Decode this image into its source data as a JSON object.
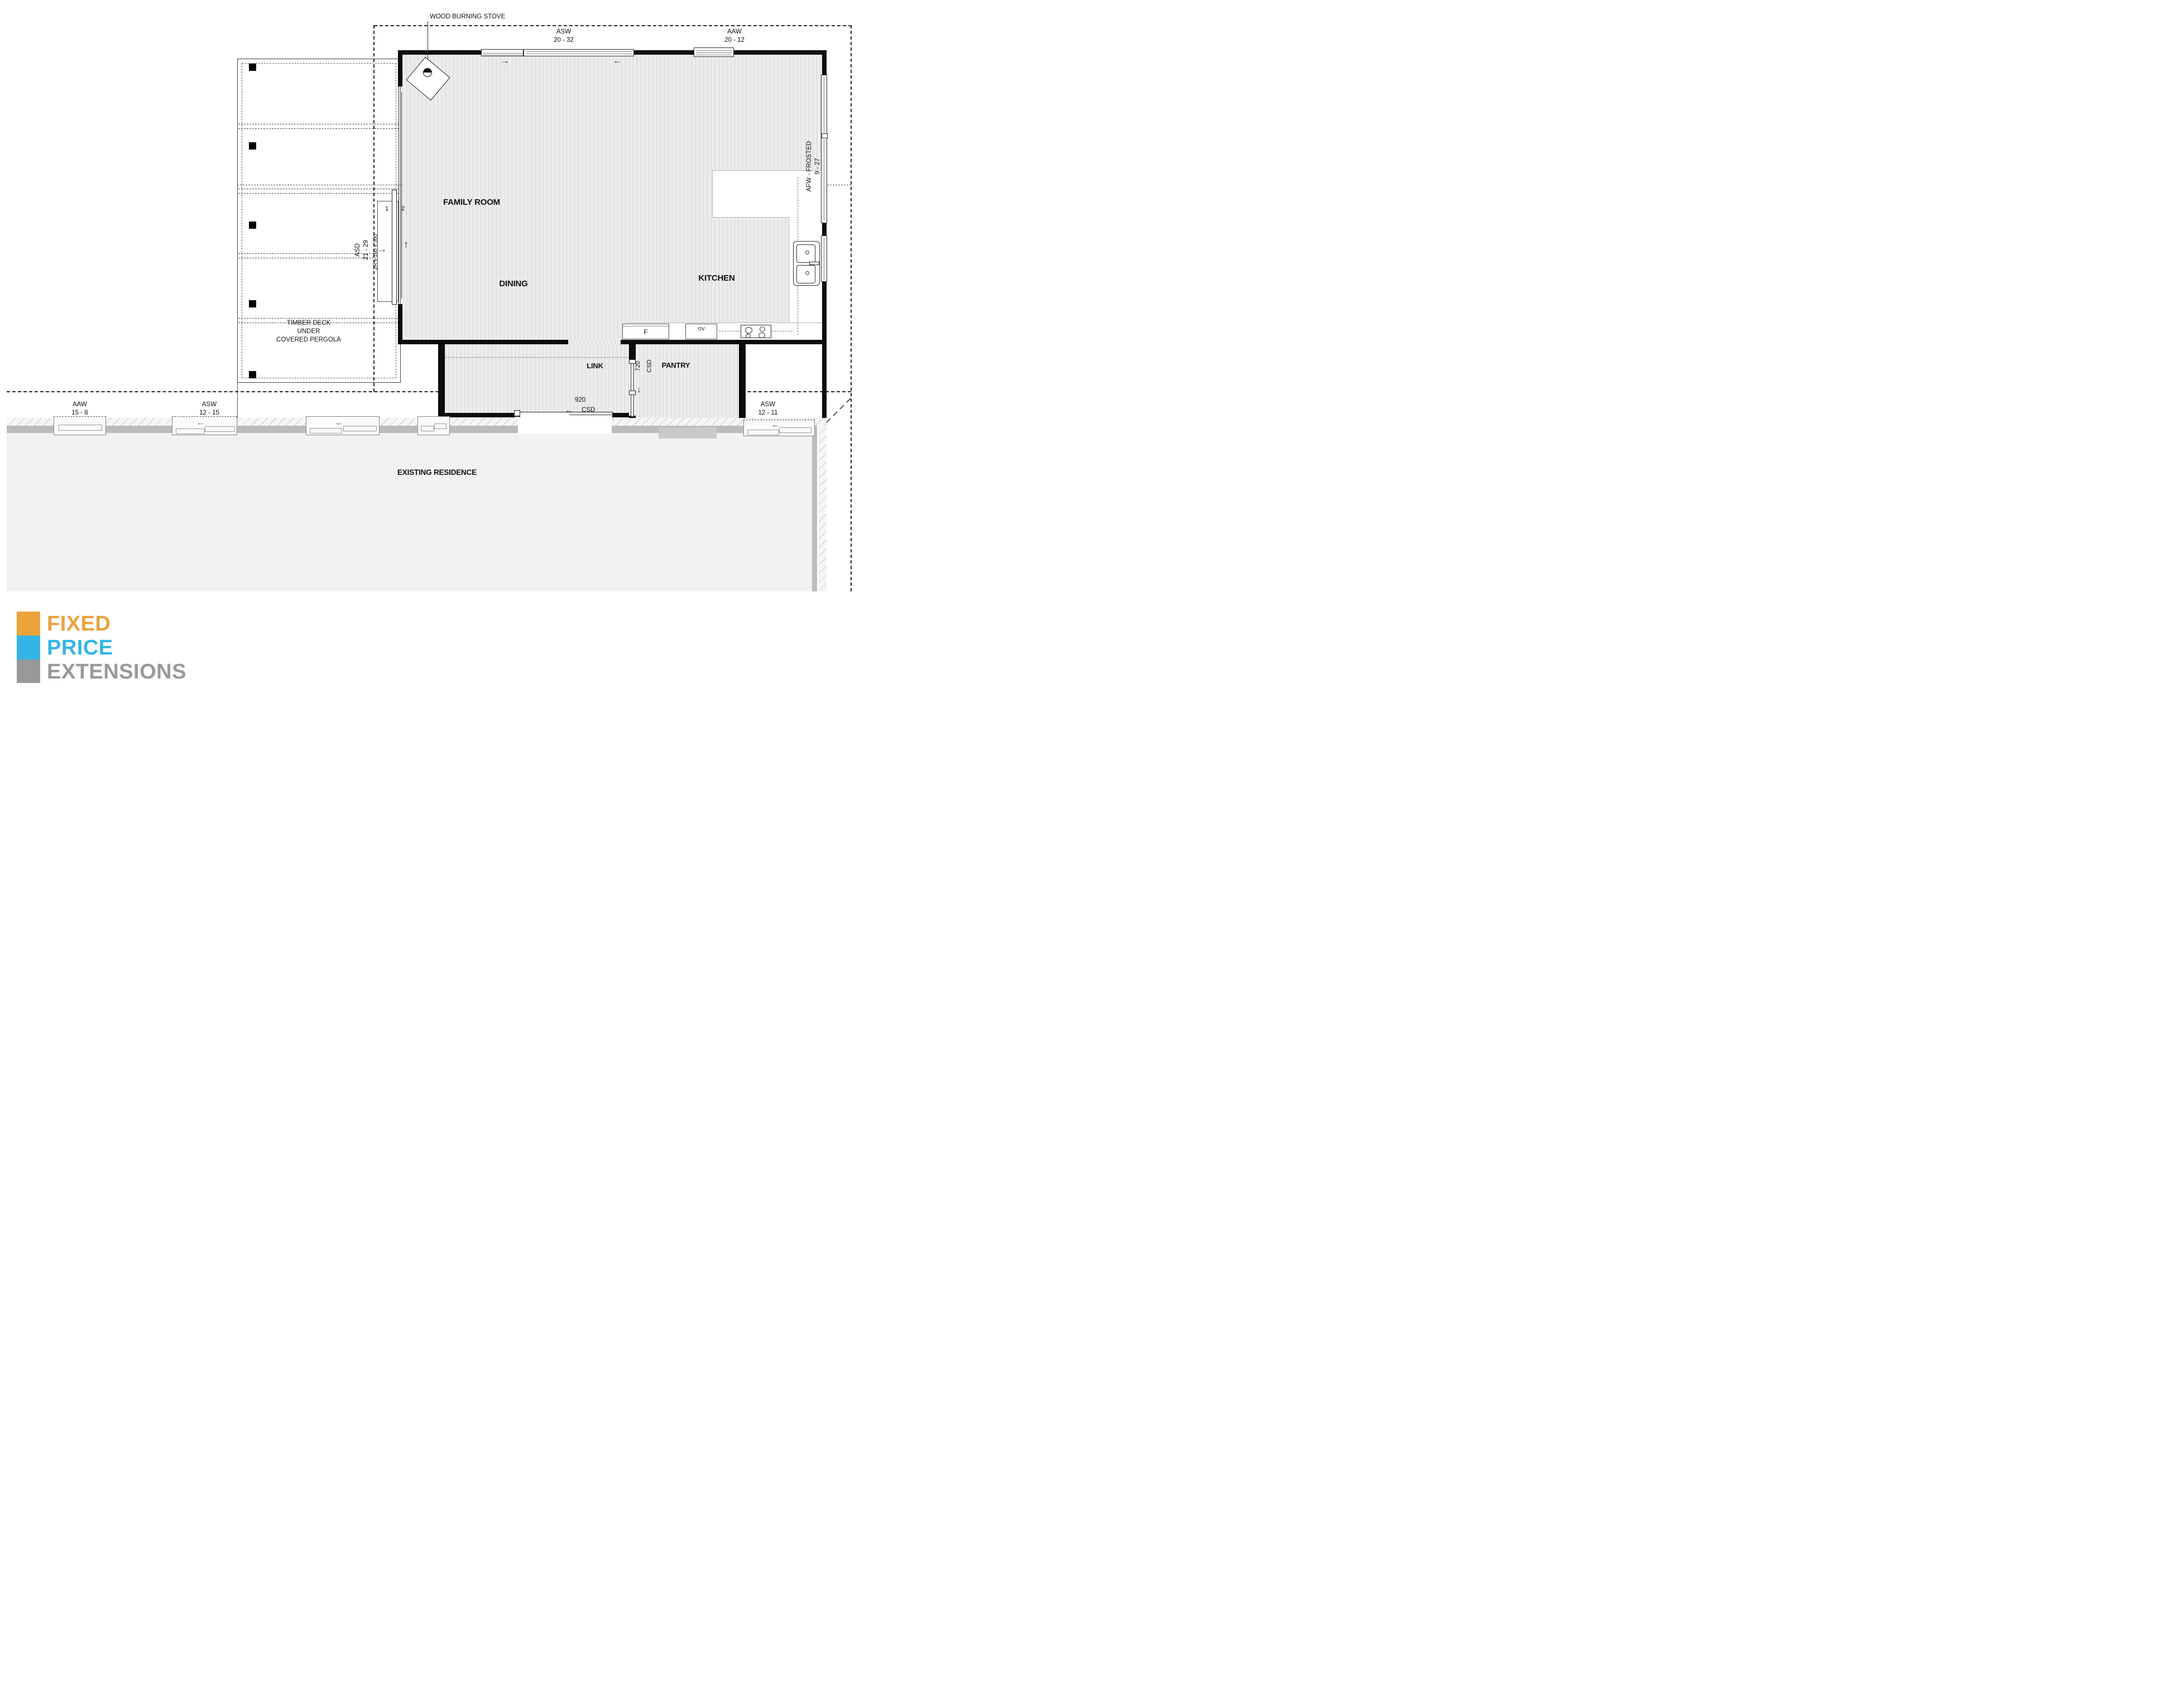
{
  "annotations": {
    "stove_note": "WOOD BURNING STOVE",
    "deck_line1": "TIMBER DECK",
    "deck_line2": "UNDER",
    "deck_line3": "COVERED PERGOLA",
    "steps_note": "2R x 150 x 300",
    "step_1": "1",
    "step_2": "2"
  },
  "rooms": {
    "family": "FAMILY ROOM",
    "dining": "DINING",
    "kitchen": "KITCHEN",
    "link": "LINK",
    "pantry": "PANTRY",
    "existing": "EXISTING RESIDENCE"
  },
  "windows": {
    "asw_top": {
      "code": "ASW",
      "size": "20 - 32"
    },
    "aaw_top": {
      "code": "AAW",
      "size": "20 - 12"
    },
    "afw_right": {
      "code": "AFW - FROSTED",
      "size": "9 - 27"
    },
    "aaw_left": {
      "code": "AAW",
      "size": "15 - 8"
    },
    "asw_mid": {
      "code": "ASW",
      "size": "12 - 15"
    },
    "asw_right": {
      "code": "ASW",
      "size": "12 - 11"
    }
  },
  "doors": {
    "asd": {
      "code": "ASD",
      "size": "21 - 29"
    },
    "csd_link": {
      "size": "920",
      "code": "CSD"
    },
    "csd_pantry": {
      "size": "720",
      "code": "CSD"
    }
  },
  "appliances": {
    "fridge": "F",
    "oven": "OV"
  },
  "icons": {
    "arrow_left": "←",
    "arrow_right": "→",
    "arrow_up": "↑",
    "arrow_down": "↓"
  },
  "logo": {
    "line1": "FIXED",
    "line2": "PRICE",
    "line3": "EXTENSIONS",
    "colors": {
      "orange": "#EBA33B",
      "blue": "#35B5E5",
      "gray": "#98999B"
    }
  }
}
